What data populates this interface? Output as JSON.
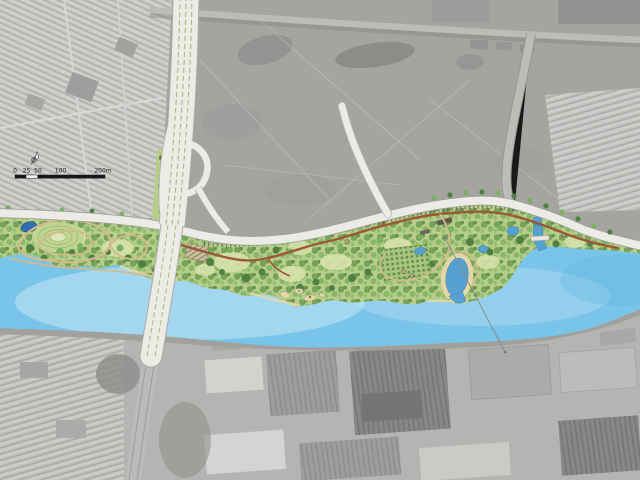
{
  "title": "Riverfront park master plan over aerial photograph",
  "scale_bar": {
    "labels": [
      "0",
      "25",
      "50",
      "100",
      "200m"
    ]
  },
  "north_arrow": {
    "icon": "compass-needle-icon"
  },
  "colors": {
    "aerial_base": "#c6c6c3",
    "aerial_scrub": "#adaca8",
    "residential": "#d8d7d4",
    "industrial_base": "#bfbfbc",
    "road_white": "#f2f1ec",
    "road_gray": "#cac9c5",
    "arterial_fringe": "#8e8d89",
    "river": "#79c9ef",
    "river_highlight": "#cfeffb",
    "quay": "#a3a29e",
    "park_base": "#b9d389",
    "canopy_dark": "#4f8040",
    "canopy_mid": "#7cb35c",
    "canopy_light": "#9ac873",
    "lawn": "#dde8ae",
    "path_main": "#9c5632",
    "path_secondary": "#d6bd8c",
    "pond_dark": "#2e6db2",
    "water_pond": "#54a3d6",
    "beach": "#e7dcab",
    "levee_tick": "#4e4e4e",
    "median_green": "#a4c182",
    "building_dark": "#5c564c",
    "hatch_tan": "#cfc3a0"
  },
  "features": [
    "aerial-photo-base",
    "residential-district-northwest",
    "residential-district-northeast",
    "scrubland-north",
    "industrial-district-south",
    "river",
    "quay-edge-south-bank",
    "riverfront-park-band",
    "levee-road",
    "highway-bridge-north-south",
    "interchange-ramp-loop",
    "connector-road",
    "east-curved-road",
    "top-arterial-road",
    "loop-trails-west",
    "main-park-path",
    "hill-mound-with-contours",
    "dark-pond-west",
    "lagoon-with-beach",
    "small-ponds",
    "channel-with-footbridge",
    "river-islands",
    "orchard-grid-planting",
    "park-buildings",
    "power-line-crossing",
    "north-arrow",
    "scale-bar"
  ]
}
